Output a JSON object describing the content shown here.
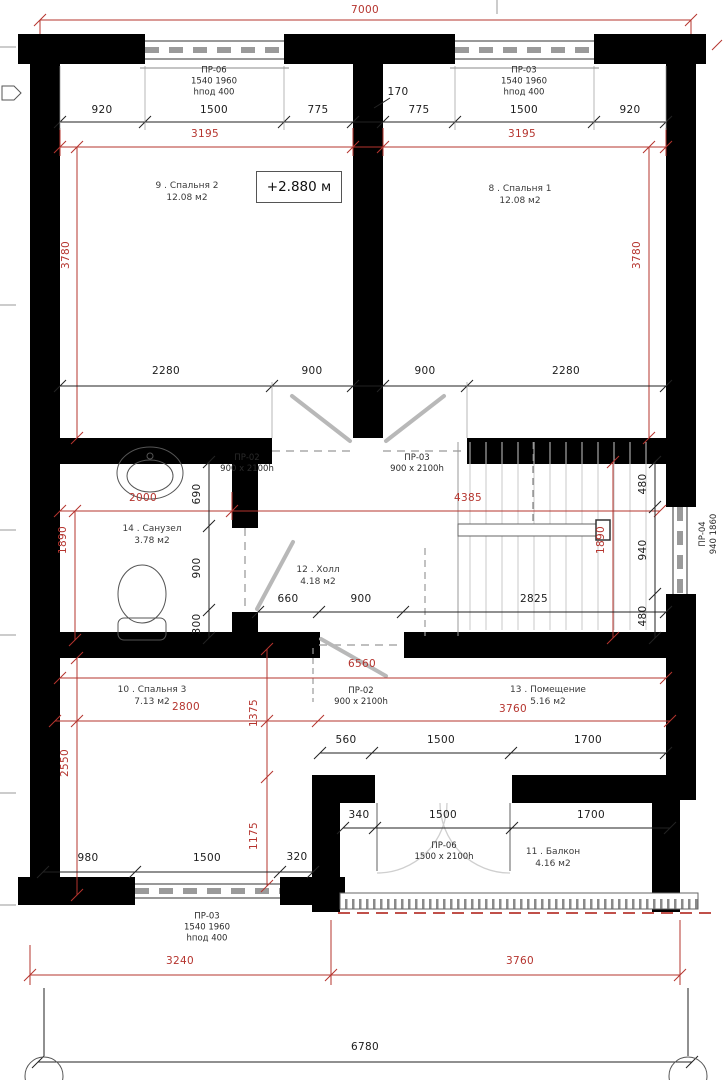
{
  "level_mark": "+2.880 м",
  "rooms": {
    "bedroom2": {
      "name": "9 . Спальня 2",
      "area": "12.08 м2"
    },
    "bedroom1": {
      "name": "8 . Спальня 1",
      "area": "12.08 м2"
    },
    "bathroom": {
      "name": "14 . Санузел",
      "area": "3.78 м2"
    },
    "hall": {
      "name": "12 . Холл",
      "area": "4.18 м2"
    },
    "bedroom3": {
      "name": "10 . Спальня 3",
      "area": "7.13 м2"
    },
    "room13": {
      "name": "13 . Помещение",
      "area": "5.16 м2"
    },
    "balcony": {
      "name": "11 . Балкон",
      "area": "4.16 м2"
    }
  },
  "openings": {
    "w_top_left": {
      "l1": "ПР-06",
      "l2": "1540 1960",
      "l3": "hпод 400"
    },
    "w_top_right": {
      "l1": "ПР-03",
      "l2": "1540 1960",
      "l3": "hпод 400"
    },
    "w_bottom": {
      "l1": "ПР-03",
      "l2": "1540 1960",
      "l3": "hпод 400"
    },
    "w_right": {
      "l1": "ПР-04",
      "l2": "940 1860"
    },
    "d_bedroom2": {
      "l1": "ПР-02",
      "l2": "900 x 2100h"
    },
    "d_bedroom1": {
      "l1": "ПР-03",
      "l2": "900 x 2100h"
    },
    "d_room13": {
      "l1": "ПР-02",
      "l2": "900 x 2100h"
    },
    "d_balcony": {
      "l1": "ПР-06",
      "l2": "1500 x 2100h"
    }
  },
  "dims_red": {
    "total_top": "7000",
    "left_3195": "3195",
    "right_3195": "3195",
    "left_3780": "3780",
    "right_3780": "3780",
    "bath_2000": "2000",
    "hall_4385": "4385",
    "left_1890": "1890",
    "right_1890": "1890",
    "width_6560": "6560",
    "bed3_2800": "2800",
    "room13_3760": "3760",
    "v_1375": "1375",
    "v_1175": "1175",
    "v_2550": "2550",
    "bottom_3240": "3240",
    "bottom_3760": "3760"
  },
  "dims_black": {
    "top": [
      "920",
      "1500",
      "775",
      "170",
      "775",
      "1500",
      "920"
    ],
    "mid": [
      "2280",
      "900",
      "900",
      "2280"
    ],
    "bath_v": [
      "690",
      "900",
      "300"
    ],
    "hall": [
      "660",
      "900",
      "2825"
    ],
    "right_v": [
      "480",
      "940",
      "480"
    ],
    "row1": [
      "560",
      "1500",
      "1700"
    ],
    "row2": [
      "340",
      "1500",
      "1700"
    ],
    "bottom_left": [
      "980",
      "1500",
      "320"
    ],
    "total_bottom": "6780"
  },
  "colors": {
    "dim_red": "#b5342e",
    "line_black": "#1c1c1c",
    "door_gray": "#b8b8b8",
    "wall": "#000000"
  }
}
